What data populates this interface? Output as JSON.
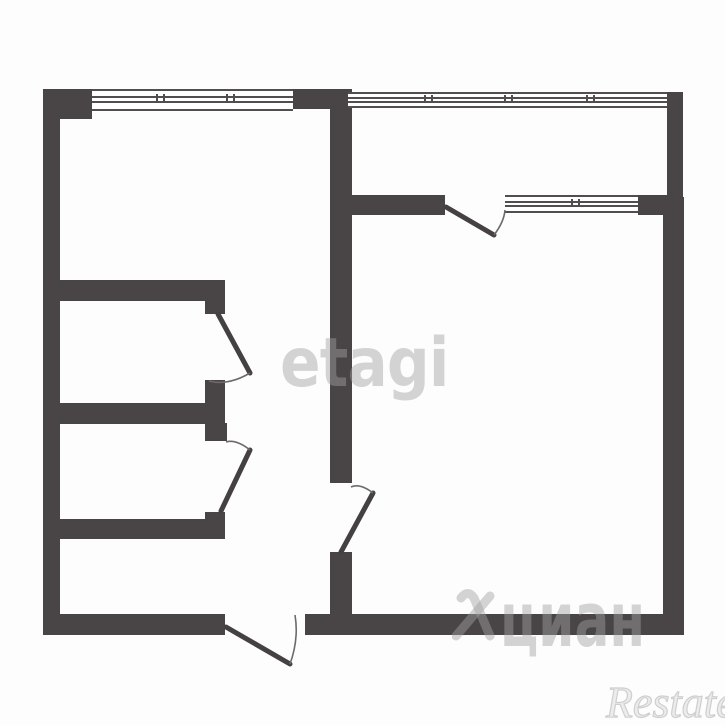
{
  "watermarks": {
    "etagi_text": "etagi",
    "cian_text": "циан",
    "restate_text": "Restate"
  },
  "colors": {
    "wall": "#494546",
    "background": "#fdfdfd",
    "door_leaf": "#454142",
    "swing_arc": "#6e6a6b",
    "window_line": "#524e4f",
    "watermark_gray": "rgba(160,160,160,0.45)"
  },
  "plan": {
    "type": "apartment-floor-plan",
    "door_count": 5,
    "window_count": 3
  }
}
